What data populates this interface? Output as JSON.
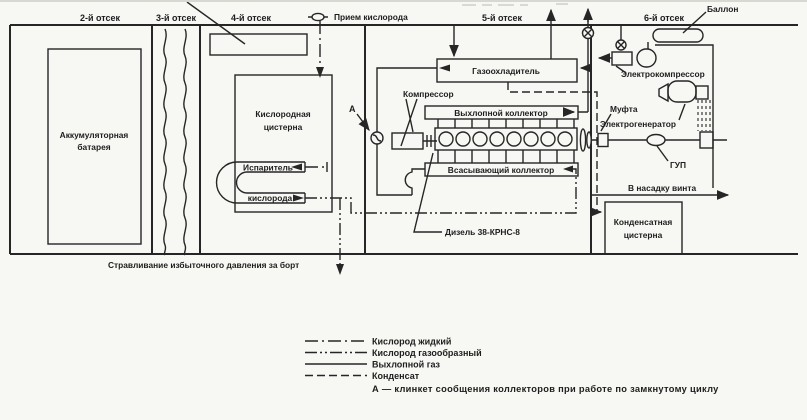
{
  "diagram": {
    "compartments": [
      "2-й отсек",
      "3-й отсек",
      "4-й отсек",
      "5-й отсек",
      "6-й отсек"
    ],
    "labels": {
      "oxygen_intake": "Прием кислорода",
      "bottle": "Баллон",
      "battery": [
        "Аккумуляторная",
        "батарея"
      ],
      "oxygen_tank": [
        "Кислородная",
        "цистерна"
      ],
      "evaporator": [
        "Испаритель",
        "кислорода"
      ],
      "gas_cooler": "Газоохладитель",
      "compressor": "Компрессор",
      "exhaust_manifold": "Выхлопной коллектор",
      "intake_manifold": "Всасывающий коллектор",
      "diesel": "Дизель 38-КРНС-8",
      "electrocompressor": "Электрокомпрессор",
      "clutch": "Муфта",
      "generator": "Электрогенератор",
      "gup": "ГУП",
      "to_propeller_nozzle": "В насадку винта",
      "condensate_tank": [
        "Конденсатная",
        "цистерна"
      ],
      "overboard_vent": "Стравливание избыточного давления за борт",
      "valve_a": "А"
    },
    "legend": {
      "items": [
        {
          "label": "Кислород жидкий",
          "style": "dashdot"
        },
        {
          "label": "Кислород газообразный",
          "style": "dashdotdot"
        },
        {
          "label": "Выхлопной газ",
          "style": "solid"
        },
        {
          "label": "Конденсат",
          "style": "dashed"
        }
      ],
      "note": "А — клинкет сообщения коллекторов при работе по замкнутому циклу"
    },
    "colors": {
      "line": "#262626",
      "background": "#f7f7f4"
    }
  }
}
